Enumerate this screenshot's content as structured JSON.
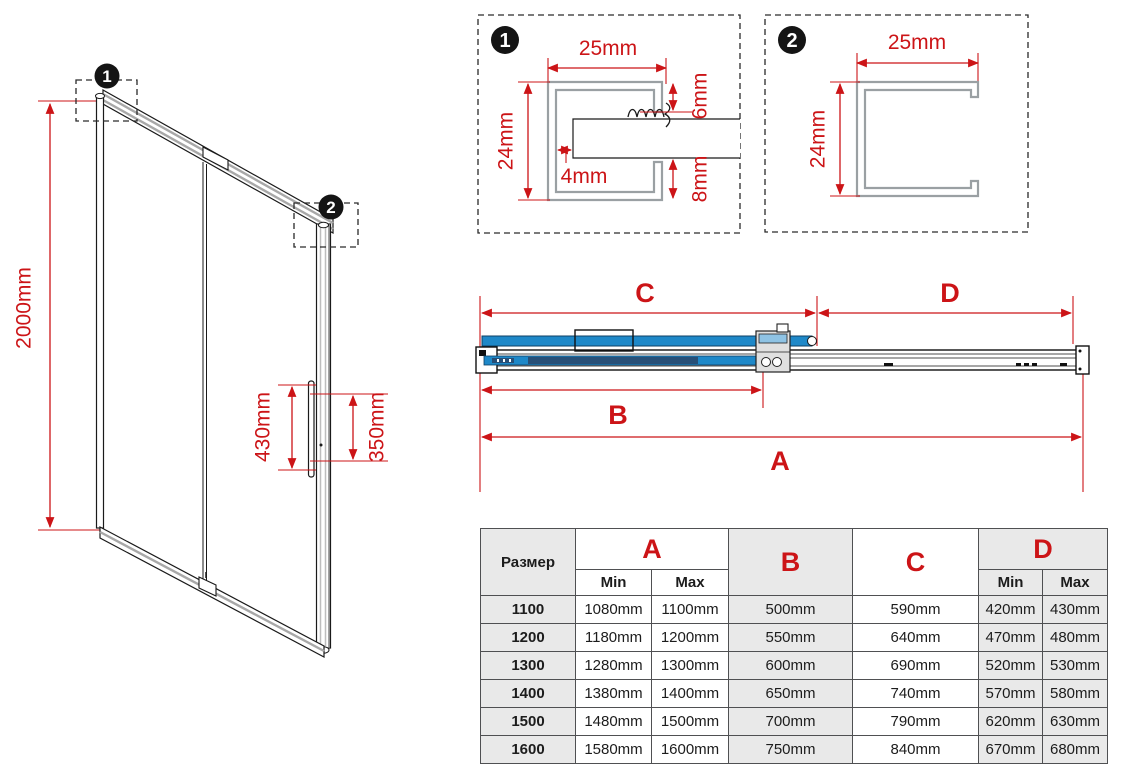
{
  "colors": {
    "dimension_red": "#cc1417",
    "glass_blue": "#1e88c8",
    "glass_dark_blue": "#274f77",
    "profile_gray": "#9aa0a3",
    "table_shade": "#e9e9e9"
  },
  "door_view": {
    "callout1": "1",
    "callout2": "2",
    "height_dim": "2000mm",
    "handle_length_dim": "430mm",
    "handle_holes_dim": "350mm"
  },
  "detail1": {
    "badge": "1",
    "width_dim": "25mm",
    "height_dim": "24mm",
    "gap_dim": "4mm",
    "top_dim": "6mm",
    "bottom_dim": "8mm"
  },
  "detail2": {
    "badge": "2",
    "width_dim": "25mm",
    "height_dim": "24mm"
  },
  "rail_view": {
    "label_a": "A",
    "label_b": "B",
    "label_c": "C",
    "label_d": "D"
  },
  "table": {
    "size_header": "Размер",
    "col_a": "A",
    "col_b": "B",
    "col_c": "C",
    "col_d": "D",
    "min": "Min",
    "max": "Max",
    "rows": [
      {
        "size": "1100",
        "a_min": "1080mm",
        "a_max": "1100mm",
        "b": "500mm",
        "c": "590mm",
        "d_min": "420mm",
        "d_max": "430mm"
      },
      {
        "size": "1200",
        "a_min": "1180mm",
        "a_max": "1200mm",
        "b": "550mm",
        "c": "640mm",
        "d_min": "470mm",
        "d_max": "480mm"
      },
      {
        "size": "1300",
        "a_min": "1280mm",
        "a_max": "1300mm",
        "b": "600mm",
        "c": "690mm",
        "d_min": "520mm",
        "d_max": "530mm"
      },
      {
        "size": "1400",
        "a_min": "1380mm",
        "a_max": "1400mm",
        "b": "650mm",
        "c": "740mm",
        "d_min": "570mm",
        "d_max": "580mm"
      },
      {
        "size": "1500",
        "a_min": "1480mm",
        "a_max": "1500mm",
        "b": "700mm",
        "c": "790mm",
        "d_min": "620mm",
        "d_max": "630mm"
      },
      {
        "size": "1600",
        "a_min": "1580mm",
        "a_max": "1600mm",
        "b": "750mm",
        "c": "840mm",
        "d_min": "670mm",
        "d_max": "680mm"
      }
    ]
  }
}
